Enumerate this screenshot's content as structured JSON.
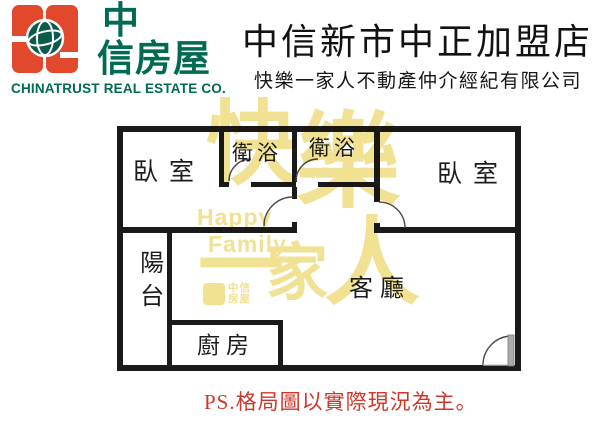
{
  "brand": {
    "icon": "chinatrust-logo-icon",
    "name_cn_top": "中",
    "name_cn_bottom": "信房屋",
    "name_en": "CHINATRUST REAL ESTATE CO.",
    "color_orange": "#E2482B",
    "color_green": "#006A52"
  },
  "header": {
    "store_title": "中信新市中正加盟店",
    "company_name": "快樂一家人不動產仲介經紀有限公司"
  },
  "floor_plan": {
    "rooms": [
      {
        "id": "bedroom-left",
        "label": "臥室"
      },
      {
        "id": "bathroom-left",
        "label": "衛浴"
      },
      {
        "id": "bathroom-right",
        "label": "衛浴"
      },
      {
        "id": "bedroom-right",
        "label": "臥室"
      },
      {
        "id": "balcony",
        "label": "陽台"
      },
      {
        "id": "living-room",
        "label": "客廳"
      },
      {
        "id": "kitchen",
        "label": "廚房"
      }
    ],
    "wall_color": "#1A1A1A"
  },
  "watermark": {
    "char_happy1": "快",
    "char_happy2": "樂",
    "char_one": "一",
    "char_family": "家",
    "char_person": "人",
    "latin_line1": "Happy",
    "latin_line2": "Family",
    "mini_brand": "中信房屋",
    "color": "#F1E193"
  },
  "footer": {
    "note": "PS.格局圖以實際現況為主。",
    "color": "#CE382A"
  }
}
